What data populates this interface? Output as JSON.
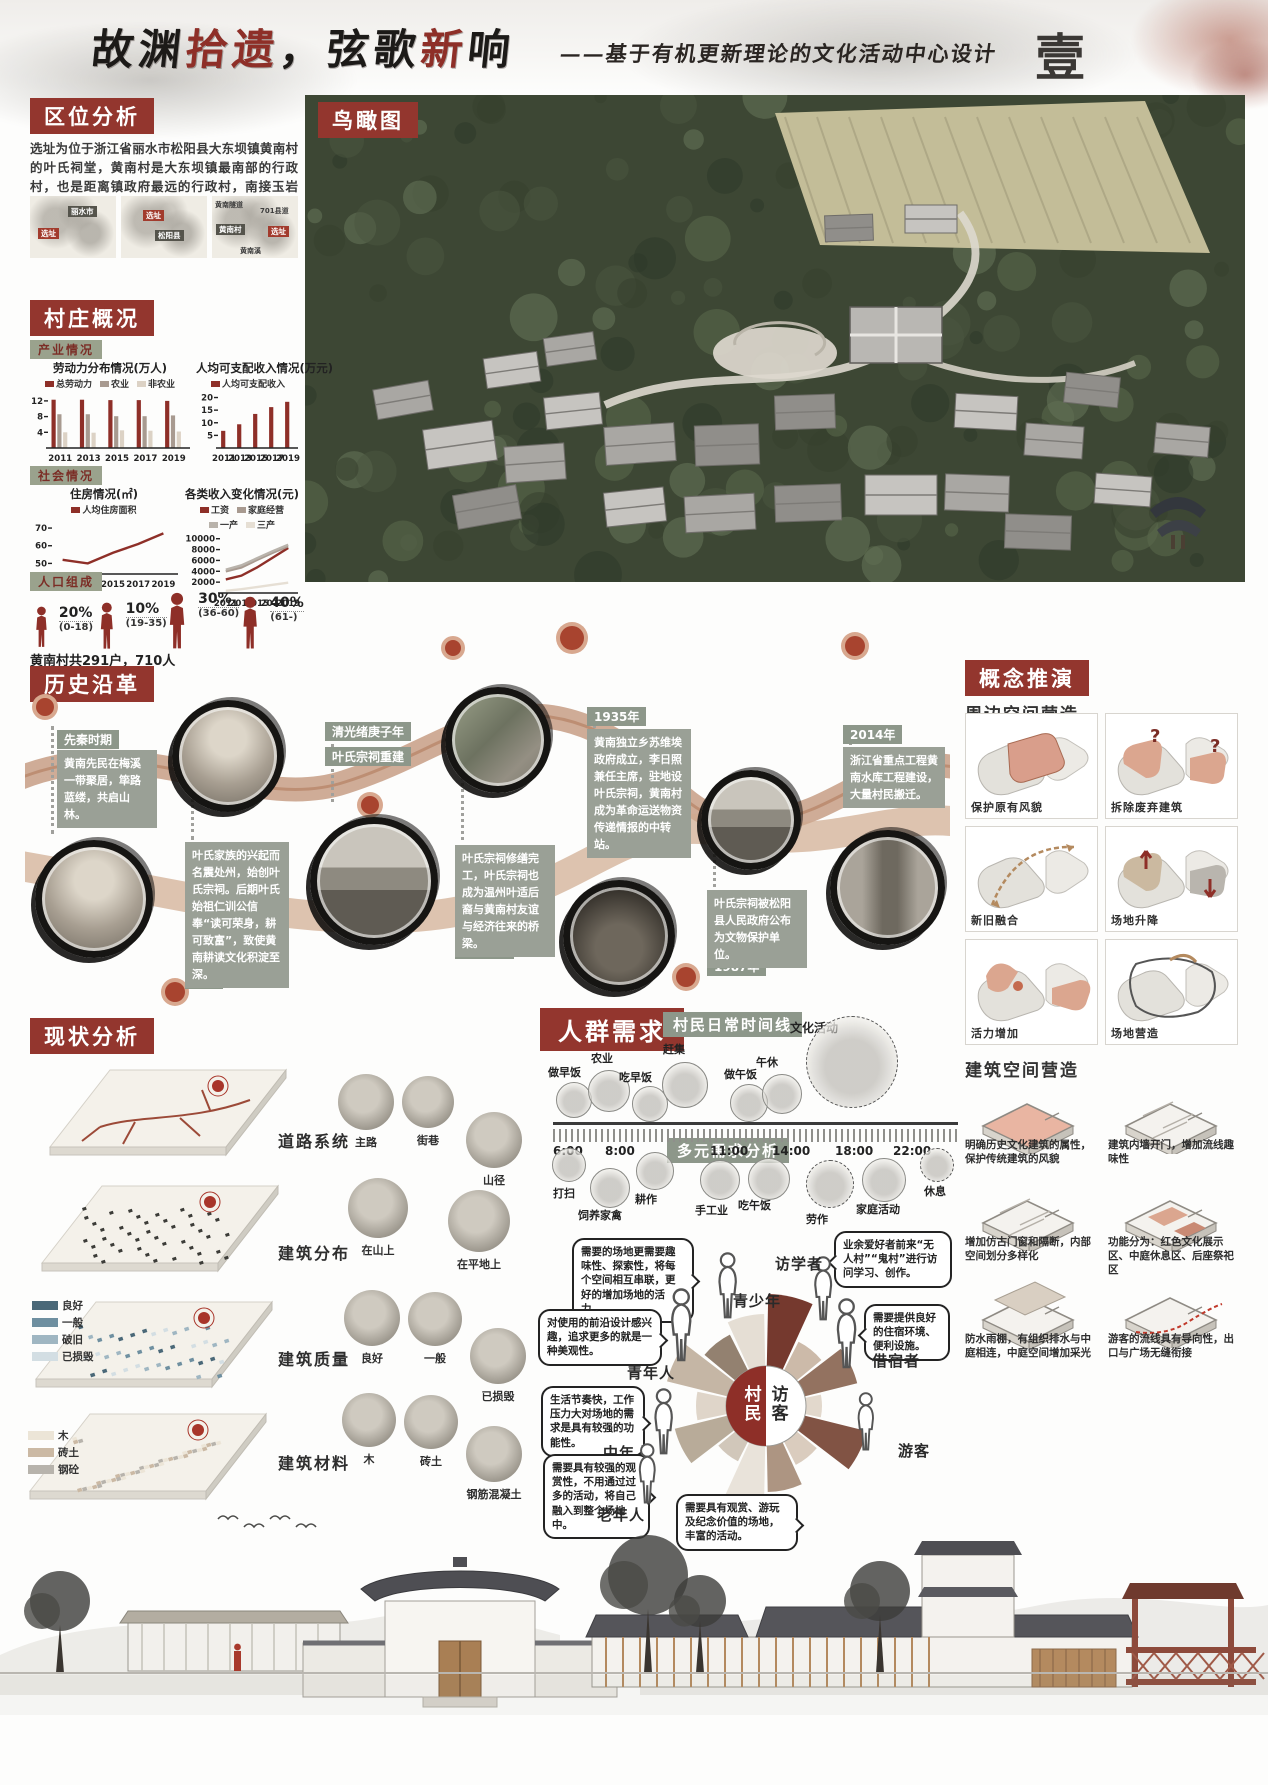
{
  "header": {
    "title_parts": [
      {
        "text": "故渊",
        "color": "#1c1a18"
      },
      {
        "text": "拾遗",
        "color": "#8e2f28"
      },
      {
        "text": "，",
        "color": "#1c1a18"
      },
      {
        "text": "弦歌",
        "color": "#1c1a18"
      },
      {
        "text": "新",
        "color": "#8e2f28"
      },
      {
        "text": "响",
        "color": "#1c1a18"
      }
    ],
    "subtitle": "——基于有机更新理论的文化活动中心设计",
    "seal_char": "壹"
  },
  "location": {
    "tag": "区位分析",
    "paragraph": "选址为位于浙江省丽水市松阳县大东坝镇黄南村的叶氏祠堂，黄南村是大东坝镇最南部的行政村，也是距离镇政府最远的行政村，南接玉岩镇。",
    "maps": [
      {
        "labels": [
          "丽水市",
          "选址"
        ]
      },
      {
        "labels": [
          "松阳县",
          "选址"
        ]
      },
      {
        "labels": [
          "黄南隧道",
          "701县道",
          "黄南村",
          "选址",
          "黄南溪"
        ]
      }
    ]
  },
  "aerial": {
    "tag": "鸟瞰图"
  },
  "village": {
    "tag": "村庄概况",
    "industry_tag": "产业情况",
    "social_tag": "社会情况",
    "population_tag": "人口组成",
    "population": [
      {
        "pct": "20%",
        "range": "(0-18)"
      },
      {
        "pct": "10%",
        "range": "(19-35)"
      },
      {
        "pct": "30%",
        "range": "(36-60)"
      },
      {
        "pct": "40%",
        "range": "(61-)"
      }
    ],
    "population_note": "黄南村共291户，710人"
  },
  "chart_data": [
    {
      "type": "bar",
      "title": "劳动力分布情况(万人)",
      "categories": [
        "2011",
        "2013",
        "2015",
        "2017",
        "2019"
      ],
      "series": [
        {
          "name": "总劳动力",
          "values": [
            12.3,
            12.3,
            12.2,
            12.2,
            12.0
          ]
        },
        {
          "name": "农业",
          "values": [
            8.6,
            8.6,
            8.1,
            8.1,
            8.3
          ]
        },
        {
          "name": "非农业",
          "values": [
            4.0,
            3.9,
            4.5,
            4.4,
            4.2
          ]
        }
      ],
      "colors": [
        "#8e2f28",
        "#a89a90",
        "#dcd2c5"
      ],
      "yticks": [
        12,
        8,
        4
      ],
      "ylim": [
        0,
        13.5
      ]
    },
    {
      "type": "bar",
      "title": "人均可支配收入情况(万元)",
      "categories": [
        "2011",
        "2013",
        "2015",
        "2017",
        "2019"
      ],
      "series": [
        {
          "name": "人均可支配收入",
          "values": [
            6.8,
            9.4,
            13.5,
            16.2,
            18.3
          ]
        }
      ],
      "colors": [
        "#8e2f28"
      ],
      "yticks": [
        20,
        15,
        10,
        5
      ],
      "ylim": [
        0,
        21
      ]
    },
    {
      "type": "line",
      "title": "住房情况(㎡)",
      "categories": [
        "2011",
        "2013",
        "2015",
        "2017",
        "2019"
      ],
      "series": [
        {
          "name": "人均住房面积",
          "values": [
            52,
            50,
            56,
            61,
            67
          ]
        }
      ],
      "colors": [
        "#8e2f28"
      ],
      "yticks": [
        70,
        60,
        50
      ],
      "ylim": [
        44,
        74
      ]
    },
    {
      "type": "line",
      "title": "各类收入变化情况(元)",
      "categories": [
        "2011",
        "2013",
        "2015",
        "2017",
        "2019"
      ],
      "series": [
        {
          "name": "工资",
          "values": [
            2500,
            3200,
            4700,
            6500,
            8300
          ]
        },
        {
          "name": "家庭经营",
          "values": [
            4000,
            4700,
            6100,
            7400,
            8600
          ]
        },
        {
          "name": "一产",
          "values": [
            4300,
            5100,
            6400,
            7700,
            8900
          ]
        },
        {
          "name": "三产",
          "values": [
            400,
            700,
            1100,
            1500,
            1900
          ]
        }
      ],
      "colors": [
        "#8e2f28",
        "#a89a90",
        "#b9b3ab",
        "#e6dfd4"
      ],
      "yticks": [
        10000,
        8000,
        6000,
        4000,
        2000
      ],
      "ylim": [
        0,
        10500
      ]
    }
  ],
  "history": {
    "tag": "历史沿革",
    "events": [
      {
        "label": "先秦时期",
        "text": "黄南先民在梅溪一带聚居，筚路蓝缕，共启山林。"
      },
      {
        "label": "宋代",
        "text": "叶氏家族的兴起而名震处州，始创叶氏宗祠。后期叶氏始祖仁训公信奉“读可荣身，耕可致富”，致使黄南耕读文化积淀至深。"
      },
      {
        "label": "清光绪庚子年",
        "text": "叶氏宗祠重建"
      },
      {
        "label": "1935年",
        "text": "黄南独立乡苏维埃政府成立，李日照兼任主席，驻地设叶氏宗祠，黄南村成为革命运送物资传递情报的中转站。"
      },
      {
        "label": "2009年",
        "text": "叶氏宗祠修缮完工，叶氏宗祠也成为温州叶适后裔与黄南村友谊与经济往来的桥梁。"
      },
      {
        "label": "1987年",
        "text": "叶氏宗祠被松阳县人民政府公布为文物保护单位。"
      },
      {
        "label": "2014年",
        "text": "浙江省重点工程黄南水库工程建设，大量村民搬迁。"
      }
    ]
  },
  "concept": {
    "tag": "概念推演",
    "surround_heading": "周边空间营造",
    "surround_items": [
      "保护原有风貌",
      "拆除废弃建筑",
      "新旧融合",
      "场地升降",
      "活力增加",
      "场地营造"
    ],
    "building_heading": "建筑空间营造",
    "building_items": [
      "明确历史文化建筑的属性，保护传统建筑的风貌",
      "建筑内墙开门，增加流线趣味性",
      "增加仿古门窗和隔断，内部空间划分多样化",
      "功能分为：红色文化展示区、中庭休息区、后座祭祀区",
      "防水雨棚，有组织排水与中庭相连，中庭空间增加采光",
      "游客的流线具有导向性，出口与广场无缝衔接"
    ]
  },
  "status": {
    "tag": "现状分析",
    "rows": [
      {
        "label": "道路系统",
        "items": [
          "主路",
          "街巷",
          "山径"
        ]
      },
      {
        "label": "建筑分布",
        "items": [
          "在山上",
          "在平地上"
        ]
      },
      {
        "label": "建筑质量",
        "items": [
          "良好",
          "一般",
          "已损毁"
        ]
      },
      {
        "label": "建筑材料",
        "items": [
          "木",
          "砖土",
          "钢筋混凝土"
        ]
      }
    ],
    "quality_legend": [
      "良好",
      "一般",
      "破旧",
      "已损毁"
    ],
    "quality_colors": [
      "#4a6878",
      "#6e8fa0",
      "#9fb6c2",
      "#d3dee3"
    ],
    "material_legend": [
      "木",
      "砖土",
      "钢砼"
    ],
    "material_colors": [
      "#ece5d7",
      "#cbb9a4",
      "#b7b3ac"
    ]
  },
  "needs": {
    "tag": "人群需求",
    "timeline_tag": "村民日常时间线",
    "culture_label": "文化活动",
    "times": [
      "6:00",
      "8:00",
      "11:00",
      "14:00",
      "18:00",
      "22:00"
    ],
    "activities_top": [
      "做早饭",
      "农业",
      "吃早饭",
      "赶集",
      "做午饭",
      "午休"
    ],
    "activities_bottom": [
      "打扫",
      "饲养家禽",
      "耕作",
      "手工业",
      "吃午饭",
      "劳作",
      "家庭活动",
      "休息"
    ],
    "analysis_tag": "多元需求分析",
    "center": {
      "left": "村民",
      "right": "访客"
    },
    "groups": [
      {
        "name": "青少年",
        "bubble": "需要的场地更需要趣味性、探索性，将每个空间相互串联，更好的增加场地的活力。"
      },
      {
        "name": "青年人",
        "bubble": "对使用的前沿设计感兴趣，追求更多的就是一种美观性。"
      },
      {
        "name": "中年人",
        "bubble": "生活节奏快，工作压力大对场地的需求是具有较强的功能性。"
      },
      {
        "name": "老年人",
        "bubble": "需要具有较强的观赏性，不用通过过多的活动，将自己融入到整个场地中。"
      },
      {
        "name": "访学者",
        "bubble": "业余爱好者前来“无人村”“鬼村”进行访问学习、创作。"
      },
      {
        "name": "借宿者",
        "bubble": "需要提供良好的住宿环境、便利设施。"
      },
      {
        "name": "游客",
        "bubble": "需要具有观赏、游玩及纪念价值的场地，丰富的活动。"
      }
    ]
  },
  "colors": {
    "accent_red": "#93362e",
    "tag_green": "#8d978a",
    "ribbon": "#c79e85"
  }
}
